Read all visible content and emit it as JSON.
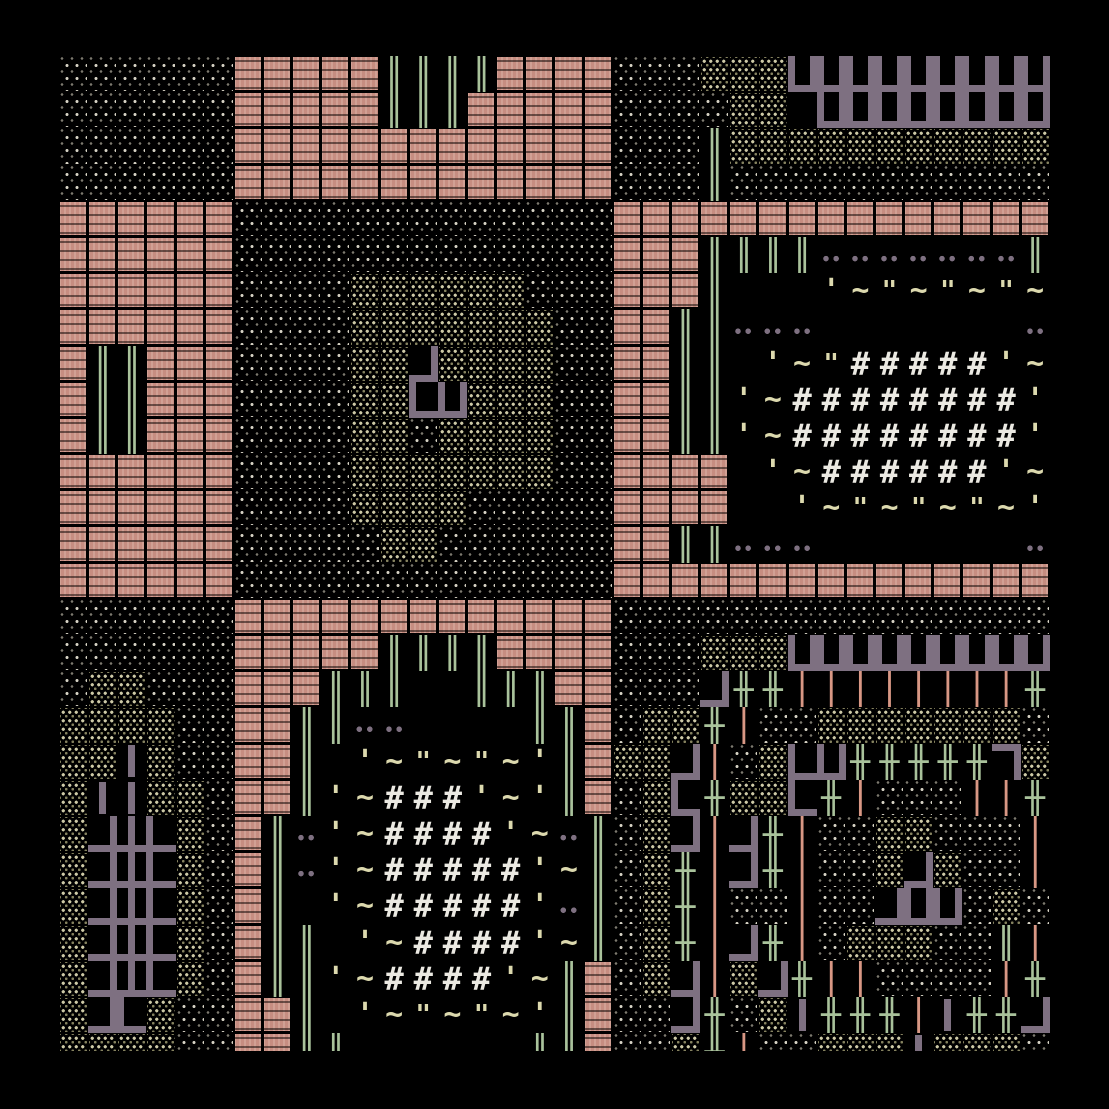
{
  "app": {
    "name": "ascii-roguelike-map",
    "description": "Top-down ASCII overworld map view: stippled terrain fields, pink brick blocks, green tree pipes, purple wall structures, and two hash-field enclosures bordered by quote-tilde rows."
  },
  "view": {
    "width": 1109,
    "height": 1109,
    "origin_x": 59,
    "origin_y": 56,
    "view_w": 991,
    "view_h": 995,
    "cols": 34,
    "rows": 28,
    "cell_w": 29.15,
    "cell_h": 36.2
  },
  "colors": {
    "background": "#000000",
    "cream": "#d6d2c4",
    "cream-dim": "#7d7a6f",
    "olive": "#cdc9a6",
    "olive-dim": "#85825f",
    "pink": "#c68d81",
    "green": "#a9c29b",
    "salmon": "#d89784",
    "purple": "#7e7081",
    "pale": "#dcd9ae",
    "white": "#ebe9e2"
  },
  "map": {
    "legend": {
      "w": "sparse-cream-stipple-terrain",
      "o": "dense-olive-stipple-terrain",
      "p": "pink-brick-block",
      "g": "green-double-pipe",
      "G": "green-cross-pipe",
      "s": "salmon-bar",
      "h": "white-hash-field",
      "q": "pale-apostrophe",
      "t": "pale-tilde",
      "d": "pale-double-quote",
      "u": "purple-u-wall",
      "L": "purple-corner-bottom-left",
      "J": "purple-corner-bottom-right",
      "7": "purple-corner-top-right",
      "F": "purple-corner-top-left",
      "T": "purple-tee-bottom",
      "|": "purple-vertical-wall",
      "-": "purple-horizontal-wall",
      "*": "purple-dot-pair",
      ".": "empty-black"
    },
    "glyphs": {
      "g": "║",
      "G": "╫",
      "s": "│",
      "h": "#",
      "q": "'",
      "t": "~",
      "d": "\""
    },
    "rows": [
      "wwwwwwpppppggggppppwwwooouuuuuuuuu",
      "wwwwwwpppppgggpppppwwwwoo.uuuuuuuu",
      "wwwwwwpppppppppppppwwwgooooooooooo",
      "wwwwwwpppppppppppppwwwgwwwwwwwwwww",
      "ppppppwwwwwwwwwwwwwppppppppppppppp",
      "ppppppwwwwwwwwwwwwwpppgggg*******g",
      "ppppppwwwwoooooowwwpppg...qtdtdtdt",
      "ppppppwwwwooooooowwppgg***.......*",
      "pggpppwwwwooJoooowwppgg.qtdhhhhhqt",
      "pggpppwwwwooLuooowwppggqthhhhhhhhq",
      "pggpppwwwwoowoooowwppggqthhhhhhhhq",
      "ppppppwwwwooooooowwpppp.qthhhhhhqt",
      "ppppppwwwwoooowwwwwpppp..qtdtdtdtq",
      "ppppppwwwwwoowwwwwwppgg***.......*",
      "ppppppwwwwwwwwwwwwwppppppppppppppp",
      "wwwwwwpppppppppppppwwwwwwwwwwwwwww",
      "wwwwwwpppppggggppppwwwooouuuuuuuuu",
      "woowwwpppggg..gggppwwwJGGssssssssG",
      "oooowwppgg**....ggpwooGswwooooooow",
      "oo|owwppg.qtdtdtqgpooJswoLuGGGGG7o",
      "o||oowppgqthhhqtqgpwoLGooLGswwwssG",
      "oJTLowpg*qthhhhqt*gwoJsJGswwoowwws",
      "oJTLowpg*qthhhhhqtgwoGsJGswwoJowws",
      "oJTLowpg.qthhhhhq*gwoGswwswwJuuwow",
      "oJTLowpgg.qthhhhqtgwoGsJGswooowwgs",
      "oJTLowpggqthhhhqtgpwoJsoJGsswwwwsG",
      "oJLowwppg.qtdtdtqgpwwJGwo|GGGs|GGJ",
      "oooowwppgg......ggpwwoGswwooo|ooow"
    ]
  }
}
